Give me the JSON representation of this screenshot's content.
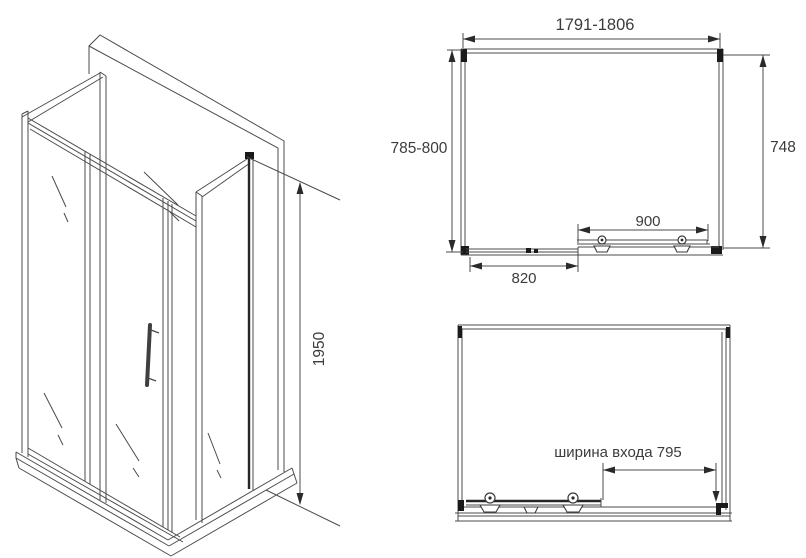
{
  "view_labels": {
    "iso_height": "1950",
    "plan_width": "1791-1806",
    "plan_depth": "785-800",
    "plan_side": "748",
    "plan_door": "900",
    "plan_fixed_panel": "820",
    "front_entrance": "ширина входа 795"
  },
  "colors": {
    "line": "#4b4b4b",
    "dark_line": "#1a1a1a",
    "text": "#3c3c3c",
    "background": "#ffffff"
  }
}
